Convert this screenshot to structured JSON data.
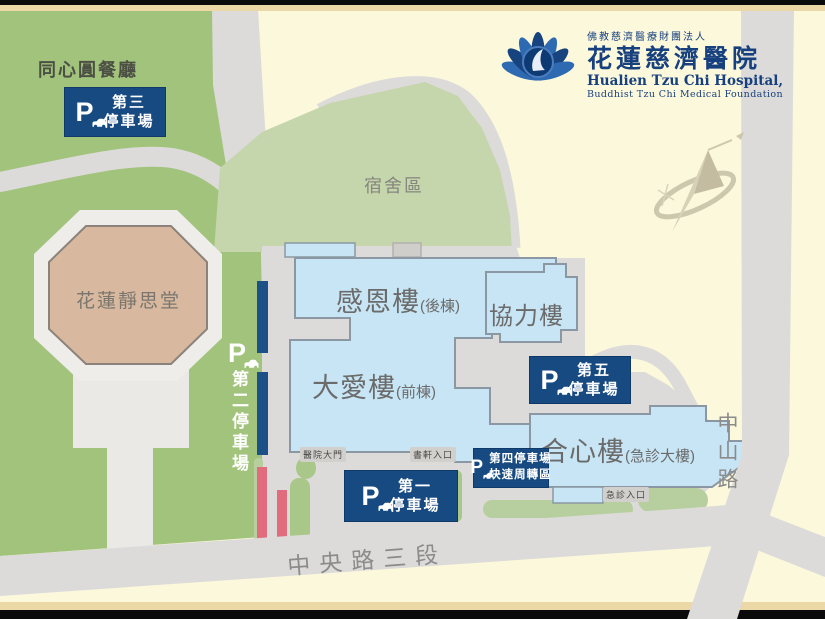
{
  "header": {
    "org": "佛教慈濟醫療財團法人",
    "hospital_zh": "花蓮慈濟醫院",
    "hospital_en": "Hualien Tzu Chi Hospital,",
    "foundation_en": "Buddhist Tzu Chi Medical Foundation"
  },
  "areas": {
    "restaurant": "同心圓餐廳",
    "dormitory": "宿舍區",
    "jingsi_hall": "花蓮靜思堂"
  },
  "buildings": {
    "ganen": {
      "name": "感恩樓",
      "annex": "(後棟)"
    },
    "daai": {
      "name": "大愛樓",
      "annex": "(前棟)"
    },
    "xieli": {
      "name": "協力樓"
    },
    "hexin": {
      "name": "合心樓",
      "annex": "(急診大樓)"
    }
  },
  "parking": {
    "p_letter": "P",
    "lot1": {
      "line1": "第一",
      "line2": "停車場"
    },
    "lot2": {
      "label": "第二停車場"
    },
    "lot3": {
      "line1": "第三",
      "line2": "停車場"
    },
    "lot4": {
      "line1": "第四停車場",
      "line2": "快速周轉區"
    },
    "lot5": {
      "line1": "第五",
      "line2": "停車場"
    }
  },
  "entrances": {
    "main_gate": "醫院大門",
    "bookstore": "書軒入口",
    "emergency": "急診入口"
  },
  "roads": {
    "central": "中央路三段",
    "zhongshan": "中山路"
  },
  "colors": {
    "badge_navy": "#164a80",
    "bar_navy": "#1c5187",
    "building_blue": "#c7e5f4",
    "campus_green": "#a2c37c",
    "dorm_green": "#c5d6ad",
    "road_gray": "#dcdbd9",
    "pink_bar": "#e06c7d",
    "cream": "#fcf8dc",
    "tan_building": "#d8b89e",
    "logo_navy": "#17407e"
  }
}
